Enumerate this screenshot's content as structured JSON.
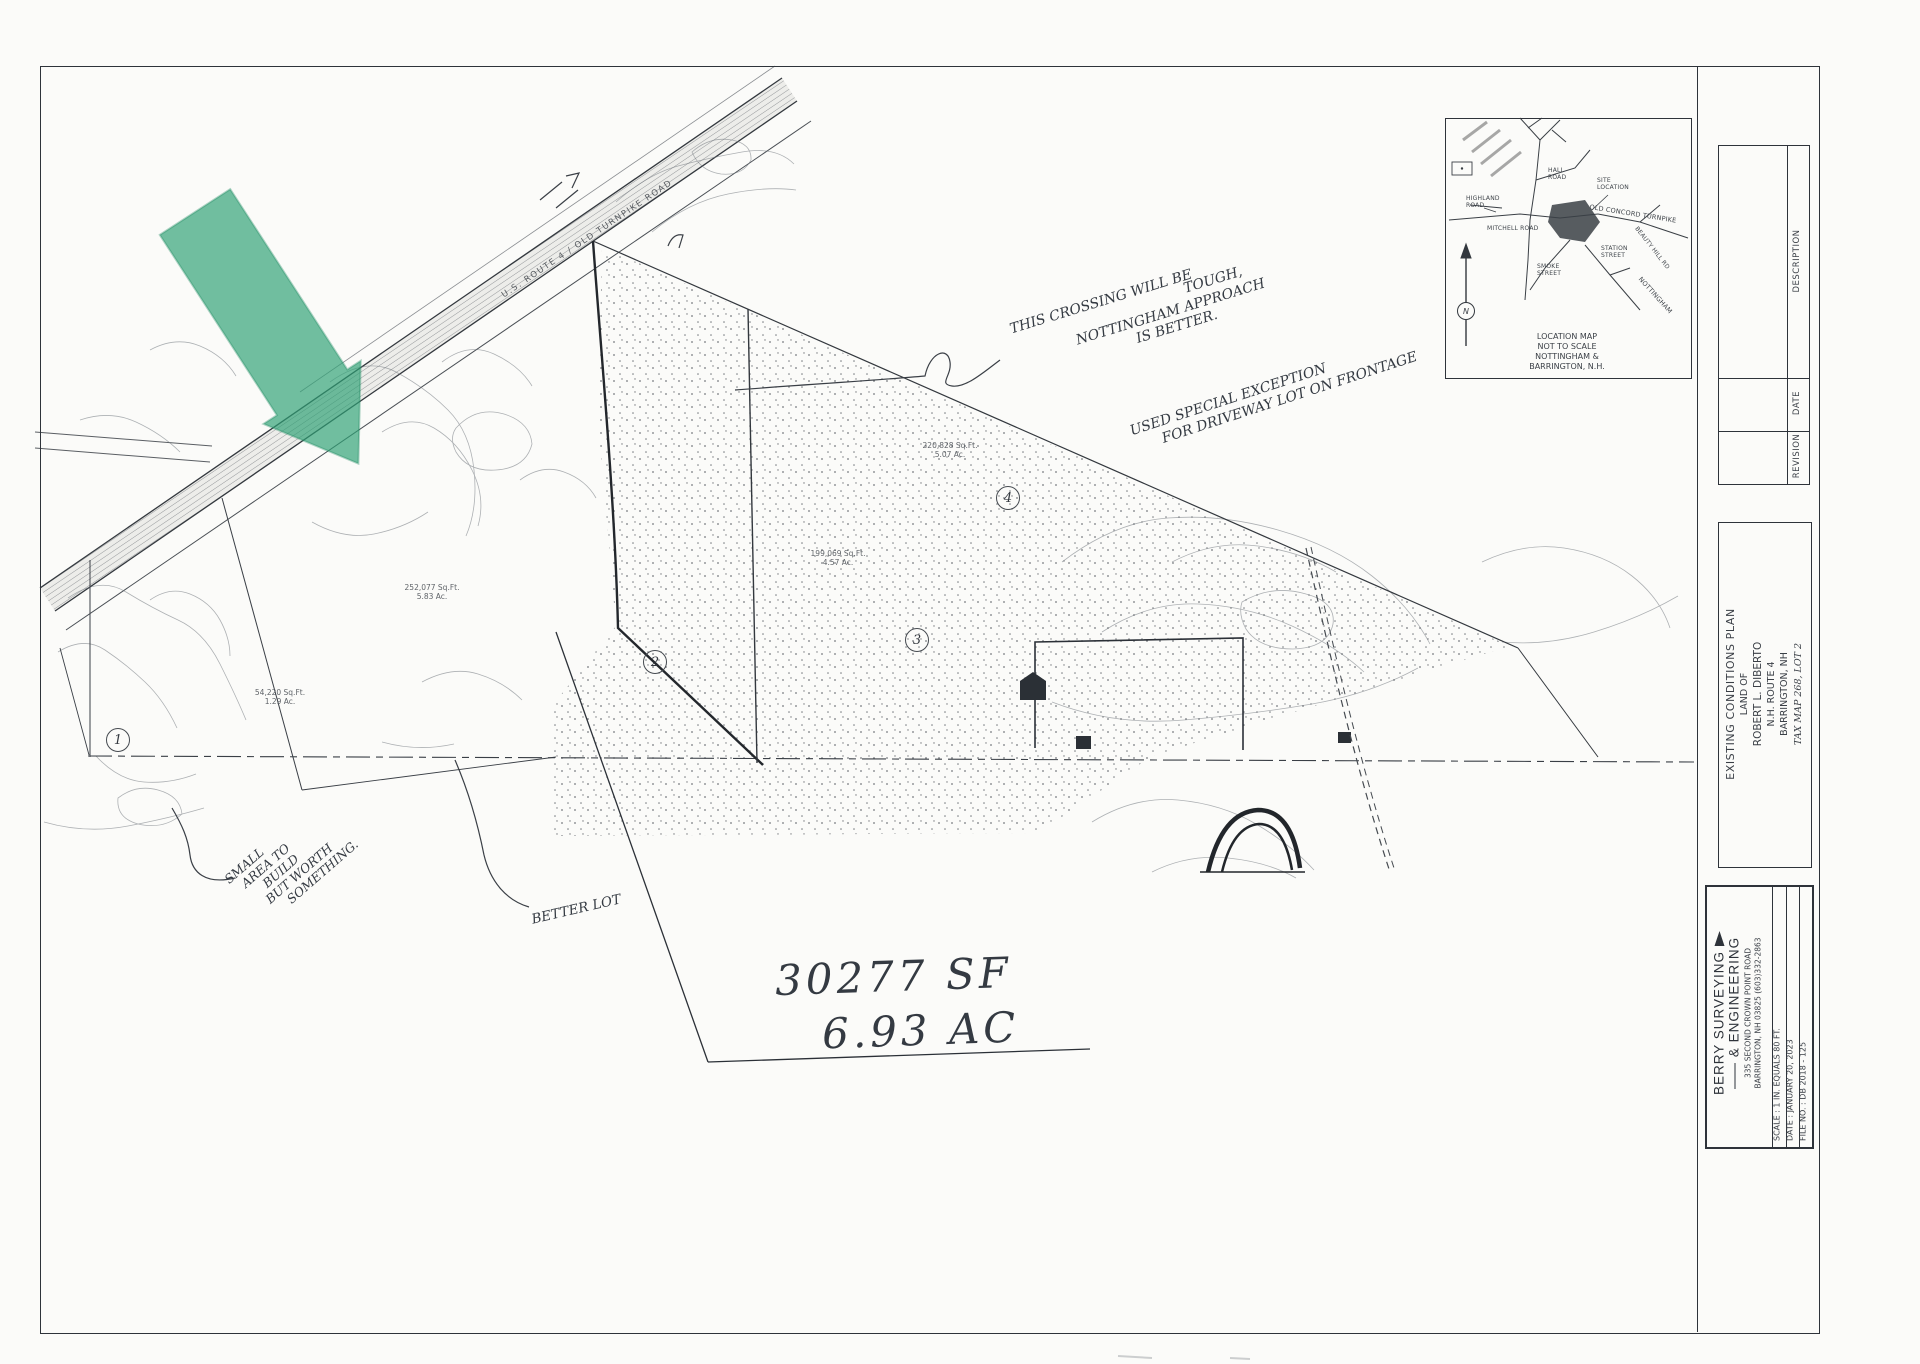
{
  "annotations": {
    "crossing_note": {
      "l1": "THIS CROSSING WILL BE",
      "l2": "TOUGH,",
      "l3": "NOTTINGHAM APPROACH",
      "l4": "IS BETTER."
    },
    "exception_note": {
      "l1": "USED SPECIAL EXCEPTION",
      "l2": "FOR DRIVEWAY LOT ON FRONTAGE"
    },
    "small_area_note": {
      "l1": "SMALL",
      "l2": "AREA TO",
      "l3": "BUILD",
      "l4": "BUT WORTH",
      "l5": "SOMETHING."
    },
    "better_lot": "BETTER LOT",
    "area_sf": "30277 SF",
    "area_ac": "6.93 AC"
  },
  "plan": {
    "road_label": "U.S. ROUTE 4  /  OLD TURNPIKE ROAD",
    "lots": [
      {
        "num": "1",
        "sqft": "54,220 Sq.Ft.",
        "acres": "1.29 Ac."
      },
      {
        "num": "2",
        "sqft": "252,077 Sq.Ft.",
        "acres": "5.83 Ac."
      },
      {
        "num": "3",
        "sqft": "199,069 Sq.Ft.",
        "acres": "4.57 Ac."
      },
      {
        "num": "4",
        "sqft": "220,828 Sq.Ft.",
        "acres": "5.07 Ac."
      }
    ]
  },
  "location_map": {
    "caption": {
      "l1": "LOCATION MAP",
      "l2": "NOT TO SCALE",
      "l3": "NOTTINGHAM &",
      "l4": "BARRINGTON, N.H."
    },
    "labels": {
      "hall": "HALL ROAD",
      "highland": "HIGHLAND ROAD",
      "mitchell": "MITCHELL ROAD",
      "site": "SITE LOCATION",
      "station": "STATION STREET",
      "smoke": "SMOKE STREET",
      "turnpike": "OLD CONCORD TURNPIKE",
      "beauty": "BEAUTY HILL RD",
      "nottingham": "NOTTINGHAM",
      "north": "N"
    }
  },
  "title_block": {
    "revision": {
      "description": "DESCRIPTION",
      "date": "DATE",
      "revision": "REVISION"
    },
    "plan_title": {
      "l1": "EXISTING CONDITIONS PLAN",
      "l2": "LAND OF",
      "l3": "ROBERT L. DIBERTO",
      "l4": "N.H. ROUTE 4",
      "l5": "BARRINGTON, NH",
      "l6": "TAX MAP 268, LOT 2"
    },
    "firm": {
      "name1": "BERRY  SURVEYING",
      "name2": "&  ENGINEERING",
      "addr1": "335 SECOND CROWN POINT ROAD",
      "addr2": "BARRINGTON, NH 03825  (603)332-2863",
      "scale": "SCALE :  1 IN. EQUALS 80 FT.",
      "date": "DATE :  JANUARY 20, 2023",
      "file": "FILE NO. :  DB 2018 - 125"
    }
  },
  "highlight_color": "#2da175"
}
